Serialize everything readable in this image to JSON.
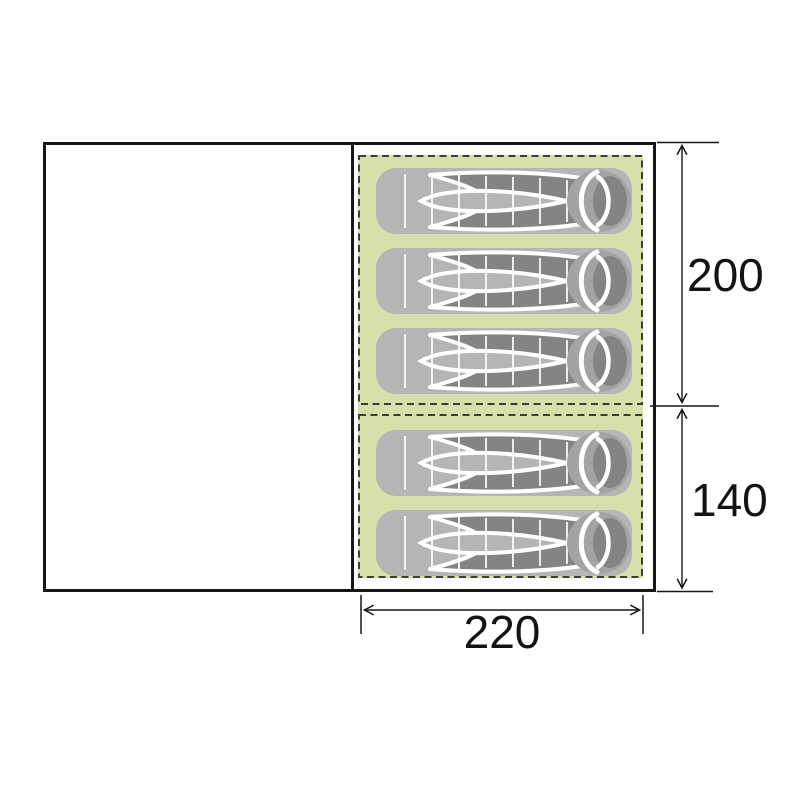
{
  "diagram": {
    "type": "tent-floorplan-top-view",
    "sleeping_area": {
      "width_cm": "220",
      "bedrooms": [
        {
          "name": "main-bedroom",
          "depth_cm": "200",
          "sleeping_bags": 3
        },
        {
          "name": "second-bedroom",
          "depth_cm": "140",
          "sleeping_bags": 2
        }
      ],
      "total_sleeping_bags": 5
    },
    "dimension_labels": {
      "width": "220",
      "main_depth": "200",
      "second_depth": "140"
    },
    "icons": {
      "sleeping_bag": "sleeping-bag-icon"
    },
    "colors": {
      "background": "#ffffff",
      "sleeping_mat_green": "#d7e0ab",
      "bag_shell_gray": "#b5b5b5",
      "bag_lining_dark": "#848484",
      "bag_rim_gray": "#a3a3a3",
      "outline_black": "#161616",
      "dashed_border": "#3b3f33"
    }
  }
}
